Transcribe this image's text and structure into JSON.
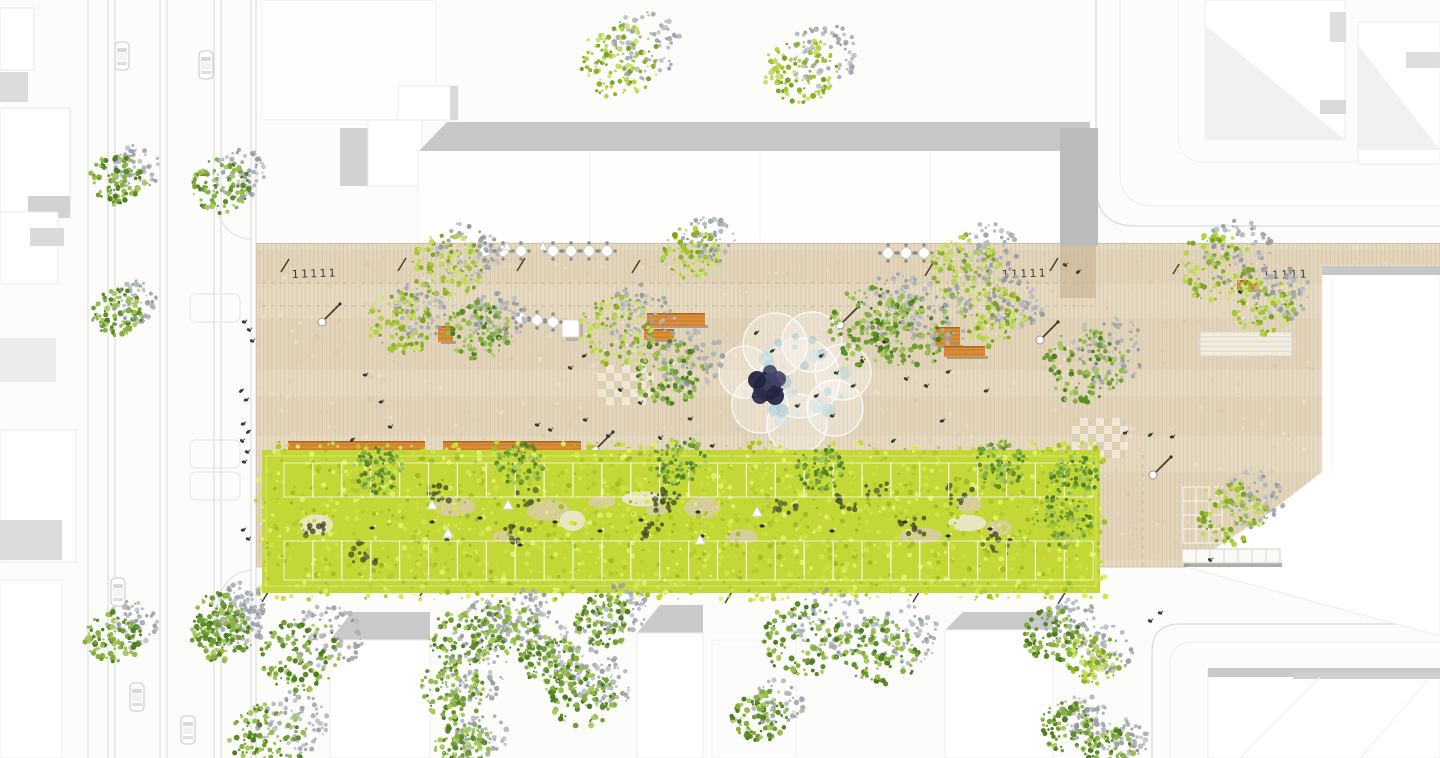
{
  "meta": {
    "title": "aerial-landscape-masterplan-site-plan",
    "canvas": {
      "w": 1440,
      "h": 758
    }
  },
  "palette": {
    "bg": "#fcfcfb",
    "plaza_base": "#e6dac2",
    "plaza_stripe": "#d8c7a8",
    "plaza_grain_dark": "#c6b190",
    "plaza_grain_light": "#f6eedb",
    "plaza_edge": "#cfc0a2",
    "road_line": "#d9d9d9",
    "roof_band": "#c8c8c8",
    "roof_end_block": "#bcbcbc",
    "canopy_base": "#c3d836",
    "canopy_pal": [
      "#c3d836",
      "#d3e54d",
      "#b1ca2b",
      "#e2ef6b",
      "#a0bc23",
      "#cbdf41"
    ],
    "canopy_dark": [
      "#74882b",
      "#5c6e24",
      "#879c2f"
    ],
    "canopy_deep": [
      "#474f2a",
      "#5a6430",
      "#3f4a28"
    ],
    "tree_green": [
      "#6f9c34",
      "#85ae41",
      "#5d8a2a",
      "#97bd4f",
      "#4f7c23",
      "#a9c95e"
    ],
    "tree_yellow": [
      "#a4c533",
      "#b4d34a",
      "#8db02c",
      "#c4da60",
      "#7ba226",
      "#cfe37a"
    ],
    "tree_shadow": [
      "#9ba1a7",
      "#aab0b5",
      "#8f959b",
      "#b8bdc2"
    ],
    "bench_orange": "#dc8d38",
    "bench_edge": "#9f621f",
    "fountain_blue": [
      "#b7d7df",
      "#9cc3cf",
      "#cfe4ea"
    ],
    "sculpture_dark": [
      "#2c2c4e",
      "#232340",
      "#44446a"
    ],
    "person": "#3a3a32"
  },
  "road_left": {
    "lines": [
      88,
      108,
      115,
      160,
      167,
      214,
      221,
      251,
      256
    ],
    "curves": [
      "M214,186 Q214,236 252,240",
      "M252,570 Q216,574 216,622"
    ],
    "parking_bays": [
      [
        190,
        294,
        50,
        28
      ],
      [
        190,
        440,
        50,
        28
      ],
      [
        190,
        472,
        50,
        28
      ]
    ]
  },
  "streets": {
    "paths": [
      {
        "d": "M1096,0 L1096,186 Q1096,226 1136,226 L1440,226",
        "c": "#e0e0e0",
        "w": 1.5
      },
      {
        "d": "M1120,0 L1120,172 Q1120,206 1154,206 L1440,206",
        "c": "#eeeeee",
        "w": 1
      },
      {
        "d": "M1152,758 L1152,652 Q1152,624 1180,624 L1440,624",
        "c": "#e0e0e0",
        "w": 1.5
      },
      {
        "d": "M1170,758 L1170,664 Q1170,642 1194,642 L1440,642",
        "c": "#eeeeee",
        "w": 1
      }
    ],
    "parcel_top_right": [
      1178,
      -24,
      286,
      186,
      24
    ]
  },
  "buildings_under": [
    {
      "t": "r",
      "v": [
        0,
        8,
        34,
        62
      ],
      "f": "#ffffff",
      "s": "#e7e7e7"
    },
    {
      "t": "r",
      "v": [
        0,
        72,
        28,
        30
      ],
      "f": "#dcdcdc"
    },
    {
      "t": "r",
      "v": [
        0,
        108,
        70,
        104
      ],
      "f": "#ffffff",
      "s": "#e7e7e7"
    },
    {
      "t": "r",
      "v": [
        28,
        196,
        42,
        22
      ],
      "f": "#d2d2d2"
    },
    {
      "t": "r",
      "v": [
        0,
        212,
        58,
        72
      ],
      "f": "#ffffff",
      "s": "#eaeaea"
    },
    {
      "t": "r",
      "v": [
        30,
        228,
        34,
        18
      ],
      "f": "#dadada"
    },
    {
      "t": "r",
      "v": [
        0,
        338,
        56,
        44
      ],
      "f": "#ececec"
    },
    {
      "t": "r",
      "v": [
        0,
        430,
        76,
        132
      ],
      "f": "#ffffff",
      "s": "#eaeaea"
    },
    {
      "t": "r",
      "v": [
        0,
        520,
        62,
        40
      ],
      "f": "#dcdcdc"
    },
    {
      "t": "r",
      "v": [
        0,
        580,
        62,
        178
      ],
      "f": "#ffffff",
      "s": "#ebebeb"
    },
    {
      "t": "r",
      "v": [
        262,
        0,
        174,
        120
      ],
      "f": "#fdfdfd",
      "s": "#f0f0f0"
    },
    {
      "t": "r",
      "v": [
        398,
        86,
        60,
        34
      ],
      "f": "#ffffff",
      "s": "#ededed"
    },
    {
      "t": "r",
      "v": [
        450,
        86,
        8,
        34
      ],
      "f": "#d9d9d9"
    },
    {
      "t": "r",
      "v": [
        340,
        128,
        28,
        58
      ],
      "f": "#d2d2d2"
    },
    {
      "t": "r",
      "v": [
        368,
        120,
        54,
        66
      ],
      "f": "#ffffff",
      "s": "#ededed"
    },
    {
      "t": "r",
      "v": [
        418,
        150,
        672,
        93
      ],
      "f": "#fefefe",
      "s": "#f1f1f1"
    },
    {
      "t": "p",
      "v": "447,122 1090,122 1090,151 419,151",
      "f": "#c8c8c8"
    },
    {
      "t": "r",
      "v": [
        1205,
        0,
        140,
        138
      ],
      "f": "#ffffff",
      "s": "#ededed"
    },
    {
      "t": "p",
      "v": "1205,25 1345,140 1205,140",
      "f": "#f1f1f1"
    },
    {
      "t": "r",
      "v": [
        1320,
        100,
        26,
        14
      ],
      "f": "#d9d9d9"
    },
    {
      "t": "r",
      "v": [
        1330,
        12,
        16,
        30
      ],
      "f": "#dedede"
    },
    {
      "t": "r",
      "v": [
        1358,
        22,
        82,
        142
      ],
      "f": "#ffffff",
      "s": "#ededed"
    },
    {
      "t": "p",
      "v": "1358,45 1440,150 1358,150",
      "f": "#f1f1f1"
    },
    {
      "t": "r",
      "v": [
        1406,
        52,
        34,
        16
      ],
      "f": "#dedede"
    },
    {
      "t": "p",
      "v": "352,612 430,612 430,640 330,640",
      "f": "#c9c9c9"
    },
    {
      "t": "r",
      "v": [
        330,
        640,
        100,
        118
      ],
      "f": "#ffffff",
      "s": "#eeeeee"
    },
    {
      "t": "p",
      "v": "660,605 703,605 703,633 637,633",
      "f": "#c9c9c9"
    },
    {
      "t": "r",
      "v": [
        637,
        633,
        66,
        125
      ],
      "f": "#ffffff",
      "s": "#eeeeee"
    },
    {
      "t": "r",
      "v": [
        712,
        640,
        84,
        118
      ],
      "f": "none",
      "s": "#f2f2f2"
    },
    {
      "t": "p",
      "v": "963,612 1053,612 1053,630 945,630",
      "f": "#c9c9c9"
    },
    {
      "t": "r",
      "v": [
        945,
        630,
        108,
        128
      ],
      "f": "#ffffff",
      "s": "#eeeeee"
    },
    {
      "t": "r",
      "v": [
        1208,
        668,
        232,
        90
      ],
      "f": "#ffffff",
      "s": "#efefef"
    },
    {
      "t": "r",
      "v": [
        1208,
        668,
        232,
        9
      ],
      "f": "#c9c9c9"
    },
    {
      "t": "r",
      "v": [
        1293,
        672,
        147,
        7
      ],
      "f": "#cfcfcf"
    }
  ],
  "plaza": {
    "rect": [
      256,
      243,
      1184,
      324
    ],
    "dashed_guides": [
      [
        262,
        283,
        1093,
        283
      ],
      [
        262,
        306,
        1093,
        306
      ]
    ],
    "dashed_vertical": [
      1143,
      455,
      1143,
      567
    ],
    "joints": [
      [
        745,
        245,
        745,
        453
      ],
      [
        930,
        245,
        930,
        453
      ]
    ],
    "bottom_edge": [
      256,
      567,
      1190,
      567
    ],
    "shadow_extension": [
      1060,
      246,
      36,
      52
    ]
  },
  "buildings_over": [
    {
      "t": "p",
      "v": "1322,266 1440,266 1440,636 1186,567 1264,517 1322,472",
      "f": "#ffffff",
      "s": "#f0ede6"
    },
    {
      "t": "p",
      "v": "1322,266 1440,266 1440,275 1322,275",
      "f": "#c6c6c6"
    },
    {
      "t": "r",
      "v": [
        1060,
        128,
        38,
        118
      ],
      "f": "#bcbcbc"
    }
  ],
  "canopy": {
    "rect": [
      262,
      450,
      838,
      143
    ],
    "grid_rows": [
      [
        463,
        34
      ],
      [
        541,
        39
      ]
    ],
    "grid_x0": 284,
    "grid_x1": 1096,
    "grid_step": 28.9,
    "triangles": [
      [
        432,
        505
      ],
      [
        448,
        533
      ],
      [
        508,
        505
      ],
      [
        700,
        540
      ],
      [
        757,
        512
      ]
    ],
    "people_under": [
      [
        432,
        522
      ],
      [
        447,
        540
      ],
      [
        372,
        528
      ],
      [
        480,
        518
      ],
      [
        555,
        522
      ],
      [
        600,
        531
      ],
      [
        641,
        520
      ],
      [
        702,
        536
      ],
      [
        762,
        526
      ],
      [
        832,
        531
      ],
      [
        948,
        536
      ],
      [
        990,
        529
      ],
      [
        520,
        545
      ],
      [
        698,
        512
      ],
      [
        905,
        522
      ],
      [
        1010,
        540
      ]
    ]
  },
  "trees": [
    [
      117,
      180,
      28,
      "g"
    ],
    [
      222,
      186,
      30,
      "g"
    ],
    [
      117,
      312,
      26,
      "g"
    ],
    [
      113,
      637,
      29,
      "g"
    ],
    [
      221,
      634,
      30,
      "g"
    ],
    [
      620,
      62,
      40,
      "y"
    ],
    [
      800,
      70,
      38,
      "y"
    ],
    [
      447,
      266,
      36,
      "y"
    ],
    [
      400,
      324,
      34,
      "y"
    ],
    [
      478,
      331,
      32,
      "g"
    ],
    [
      690,
      253,
      29,
      "y"
    ],
    [
      616,
      331,
      38,
      "y"
    ],
    [
      668,
      372,
      36,
      "g"
    ],
    [
      870,
      327,
      43,
      "g"
    ],
    [
      965,
      268,
      36,
      "y"
    ],
    [
      994,
      317,
      33,
      "y"
    ],
    [
      911,
      331,
      41,
      "g"
    ],
    [
      1084,
      367,
      41,
      "g"
    ],
    [
      1215,
      268,
      38,
      "y"
    ],
    [
      1263,
      306,
      31,
      "y"
    ],
    [
      1230,
      513,
      35,
      "y"
    ],
    [
      222,
      618,
      29,
      "g"
    ],
    [
      301,
      654,
      41,
      "g"
    ],
    [
      268,
      739,
      39,
      "g"
    ],
    [
      461,
      639,
      32,
      "g"
    ],
    [
      452,
      691,
      33,
      "g"
    ],
    [
      463,
      748,
      29,
      "g"
    ],
    [
      506,
      633,
      35,
      "g"
    ],
    [
      551,
      662,
      30,
      "g"
    ],
    [
      604,
      620,
      29,
      "g"
    ],
    [
      583,
      697,
      33,
      "g"
    ],
    [
      803,
      640,
      41,
      "g"
    ],
    [
      881,
      652,
      38,
      "g"
    ],
    [
      760,
      716,
      29,
      "g"
    ],
    [
      1053,
      636,
      30,
      "g"
    ],
    [
      1094,
      659,
      27,
      "y"
    ],
    [
      1067,
      727,
      27,
      "g"
    ],
    [
      1108,
      751,
      26,
      "g"
    ]
  ],
  "canopy_trees": [
    [
      380,
      470,
      26
    ],
    [
      520,
      464,
      24
    ],
    [
      680,
      461,
      27
    ],
    [
      820,
      469,
      24
    ],
    [
      1000,
      464,
      26
    ],
    [
      1062,
      520,
      30
    ],
    [
      1075,
      475,
      24
    ]
  ],
  "benches": [
    {
      "x": 288,
      "y": 441,
      "w": 137,
      "h": 13,
      "big": true
    },
    {
      "x": 443,
      "y": 441,
      "w": 138,
      "h": 12,
      "big": true
    },
    {
      "x": 438,
      "y": 326,
      "w": 15,
      "h": 16,
      "big": false
    },
    {
      "x": 647,
      "y": 313,
      "w": 58,
      "h": 13,
      "big": false
    },
    {
      "x": 644,
      "y": 329,
      "w": 30,
      "h": 11,
      "big": false
    },
    {
      "x": 934,
      "y": 327,
      "w": 26,
      "h": 19,
      "big": false
    },
    {
      "x": 944,
      "y": 346,
      "w": 41,
      "h": 11,
      "big": false
    },
    {
      "x": 1237,
      "y": 280,
      "w": 22,
      "h": 10,
      "big": false
    }
  ],
  "cafe_tables": {
    "rows": [
      [
        485,
        251
      ],
      [
        503,
        251
      ],
      [
        521,
        251
      ],
      [
        553,
        251
      ],
      [
        571,
        251
      ],
      [
        589,
        251
      ],
      [
        607,
        251
      ],
      [
        888,
        253
      ],
      [
        906,
        253
      ],
      [
        924,
        253
      ],
      [
        521,
        318
      ],
      [
        537,
        320
      ],
      [
        553,
        322
      ]
    ],
    "flags": [
      [
        507,
        247
      ],
      [
        543,
        247
      ]
    ]
  },
  "kiosk": [
    562,
    320,
    17
  ],
  "white_bench": [
    1182,
    549,
    98,
    14
  ],
  "ramp": [
    1200,
    332,
    92,
    24
  ],
  "checkers": [
    [
      598,
      365,
      54,
      38
    ],
    [
      1072,
      418,
      52,
      40
    ]
  ],
  "grid_patch": [
    1183,
    487,
    40,
    56
  ],
  "bike_racks": {
    "symbol": "11111",
    "positions": [
      [
        292,
        278
      ],
      [
        1002,
        278
      ],
      [
        1263,
        279
      ]
    ]
  },
  "slashes": [
    [
      281,
      266
    ],
    [
      398,
      265
    ],
    [
      517,
      265
    ],
    [
      632,
      267
    ],
    [
      925,
      270
    ],
    [
      1050,
      265
    ],
    [
      1173,
      268
    ],
    [
      262,
      596
    ],
    [
      420,
      590
    ],
    [
      725,
      597
    ],
    [
      913,
      596
    ],
    [
      1058,
      598
    ]
  ],
  "lamps": [
    [
      332,
      312
    ],
    [
      850,
      315
    ],
    [
      1050,
      330
    ],
    [
      1163,
      465
    ],
    [
      605,
      440
    ]
  ],
  "fountain": {
    "center": [
      800,
      378
    ],
    "circles": [
      [
        775,
        345,
        32
      ],
      [
        812,
        342,
        30
      ],
      [
        843,
        372,
        28
      ],
      [
        835,
        408,
        28
      ],
      [
        797,
        424,
        30
      ],
      [
        760,
        405,
        28
      ],
      [
        745,
        372,
        26
      ],
      [
        800,
        378,
        40
      ]
    ],
    "sculpture": [
      [
        767,
        387,
        14
      ],
      [
        757,
        380,
        9
      ],
      [
        778,
        379,
        8
      ],
      [
        760,
        396,
        8
      ],
      [
        775,
        396,
        9
      ],
      [
        770,
        372,
        7
      ]
    ]
  },
  "people": [
    [
      244,
      322
    ],
    [
      249,
      330
    ],
    [
      252,
      341
    ],
    [
      241,
      391
    ],
    [
      246,
      400
    ],
    [
      243,
      424
    ],
    [
      248,
      432
    ],
    [
      242,
      441
    ],
    [
      247,
      452
    ],
    [
      244,
      462
    ],
    [
      243,
      530
    ],
    [
      248,
      539
    ],
    [
      365,
      375
    ],
    [
      381,
      402
    ],
    [
      390,
      427
    ],
    [
      352,
      440
    ],
    [
      537,
      425
    ],
    [
      550,
      430
    ],
    [
      570,
      368
    ],
    [
      584,
      356
    ],
    [
      620,
      390
    ],
    [
      640,
      403
    ],
    [
      585,
      420
    ],
    [
      608,
      436
    ],
    [
      660,
      438
    ],
    [
      690,
      419
    ],
    [
      712,
      446
    ],
    [
      756,
      333
    ],
    [
      772,
      351
    ],
    [
      821,
      356
    ],
    [
      836,
      373
    ],
    [
      853,
      386
    ],
    [
      816,
      396
    ],
    [
      797,
      406
    ],
    [
      832,
      416
    ],
    [
      862,
      361
    ],
    [
      884,
      342
    ],
    [
      906,
      379
    ],
    [
      926,
      386
    ],
    [
      948,
      372
    ],
    [
      986,
      391
    ],
    [
      942,
      421
    ],
    [
      893,
      441
    ],
    [
      1065,
      265
    ],
    [
      1078,
      272
    ],
    [
      1125,
      433
    ],
    [
      1150,
      435
    ],
    [
      1172,
      437
    ],
    [
      1240,
      292
    ],
    [
      1210,
      560
    ],
    [
      1160,
      613
    ],
    [
      1150,
      621
    ]
  ],
  "cars": [
    [
      122,
      56
    ],
    [
      206,
      65
    ],
    [
      118,
      592
    ],
    [
      137,
      697
    ],
    [
      188,
      730
    ]
  ]
}
